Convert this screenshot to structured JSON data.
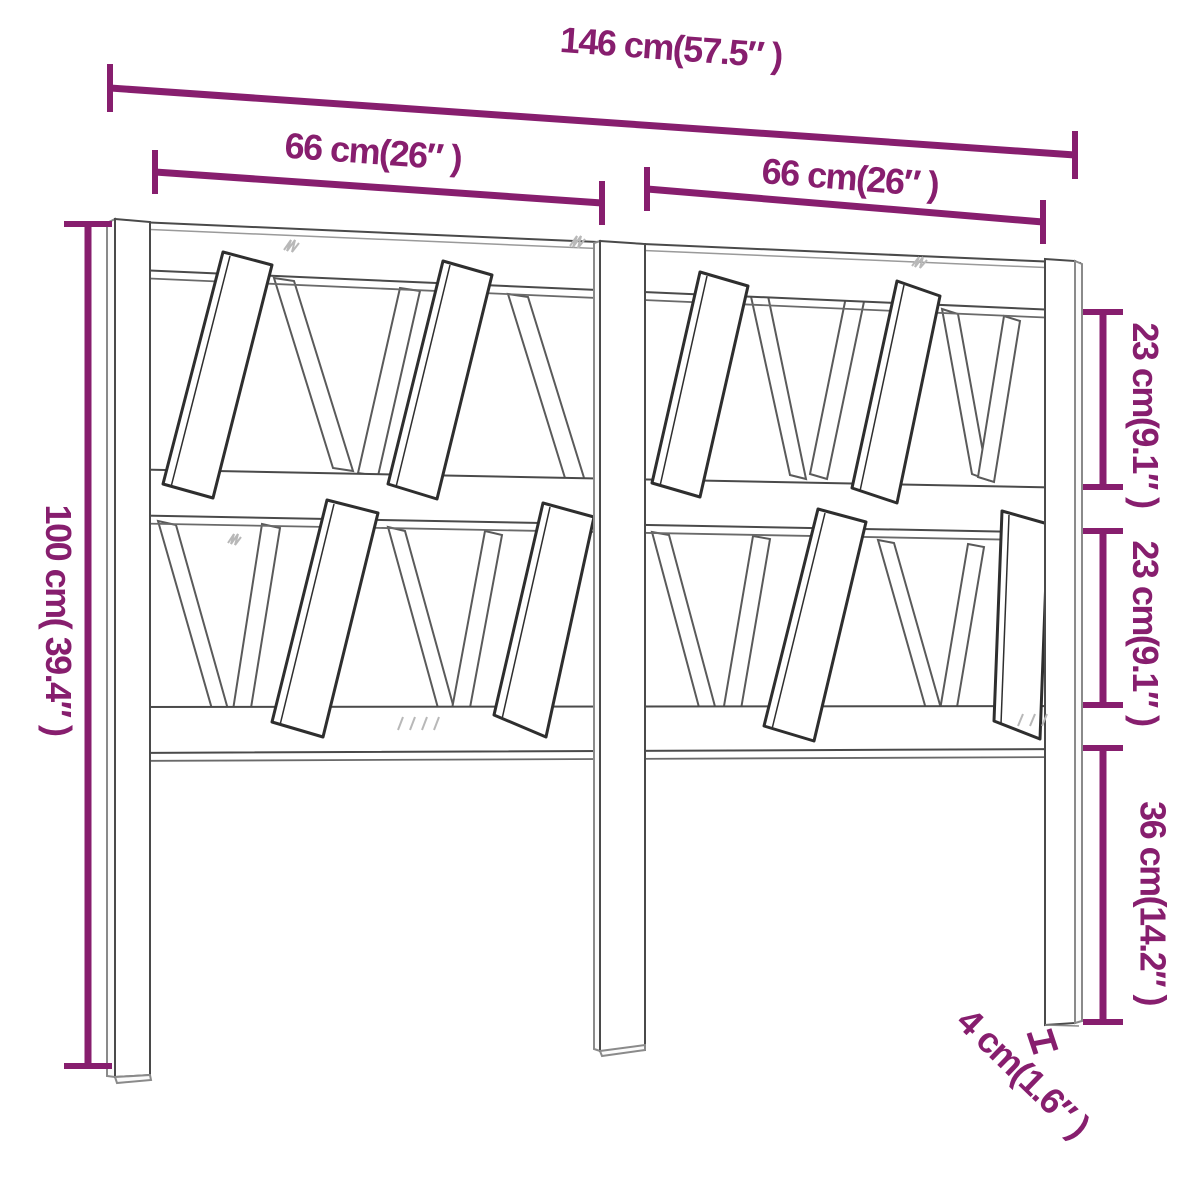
{
  "diagram": {
    "type": "furniture-dimension-diagram",
    "subject": "slatted wooden headboard, front view line drawing",
    "accent_color": "#871e6e",
    "outline_color": "#4a4a4a",
    "background": "#ffffff",
    "dimensions": {
      "total_width": "146 cm(57.5″ )",
      "left_section_width": "66 cm(26″ )",
      "right_section_width": "66 cm(26″ )",
      "total_height": "100 cm( 39.4″ )",
      "upper_row_height": "23 cm(9.1″ )",
      "lower_row_height": "23 cm(9.1″ )",
      "leg_height": "36 cm(14.2″ )",
      "post_thickness": "4 cm(1.6″ )"
    }
  }
}
